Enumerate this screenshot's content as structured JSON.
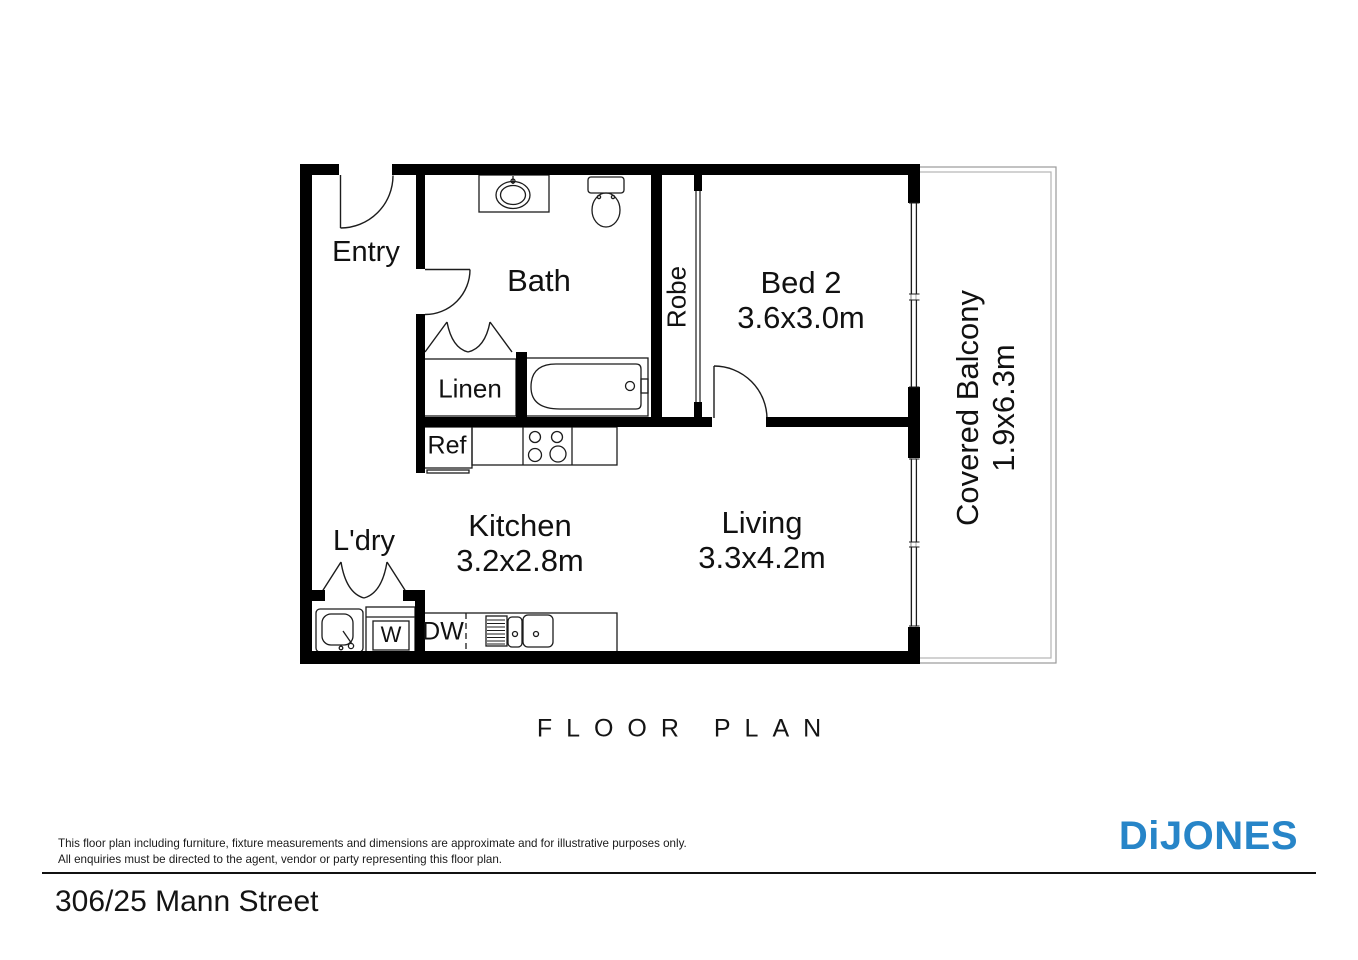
{
  "floor_plan": {
    "title": "FLOOR PLAN",
    "rooms": {
      "entry": {
        "label": "Entry"
      },
      "bath": {
        "label": "Bath"
      },
      "linen": {
        "label": "Linen"
      },
      "robe": {
        "label": "Robe"
      },
      "bed2": {
        "label": "Bed 2",
        "dimensions": "3.6x3.0m"
      },
      "kitchen": {
        "label": "Kitchen",
        "dimensions": "3.2x2.8m"
      },
      "living": {
        "label": "Living",
        "dimensions": "3.3x4.2m"
      },
      "ldry": {
        "label": "L'dry"
      },
      "balcony": {
        "label": "Covered Balcony",
        "dimensions": "1.9x6.3m"
      }
    },
    "fixtures": {
      "ref": {
        "label": "Ref"
      },
      "dw": {
        "label": "DW"
      },
      "washer": {
        "label": "W"
      }
    },
    "line_color": "#1c1c1c",
    "wall_color": "#000000"
  },
  "footer": {
    "disclaimer_line1": "This floor plan including furniture, fixture measurements and dimensions are approximate and for illustrative purposes only.",
    "disclaimer_line2": "All enquiries must be directed to the agent, vendor or party representing this floor plan.",
    "address": "306/25 Mann Street",
    "brand": "DiJONES",
    "brand_color": "#2785C8"
  }
}
